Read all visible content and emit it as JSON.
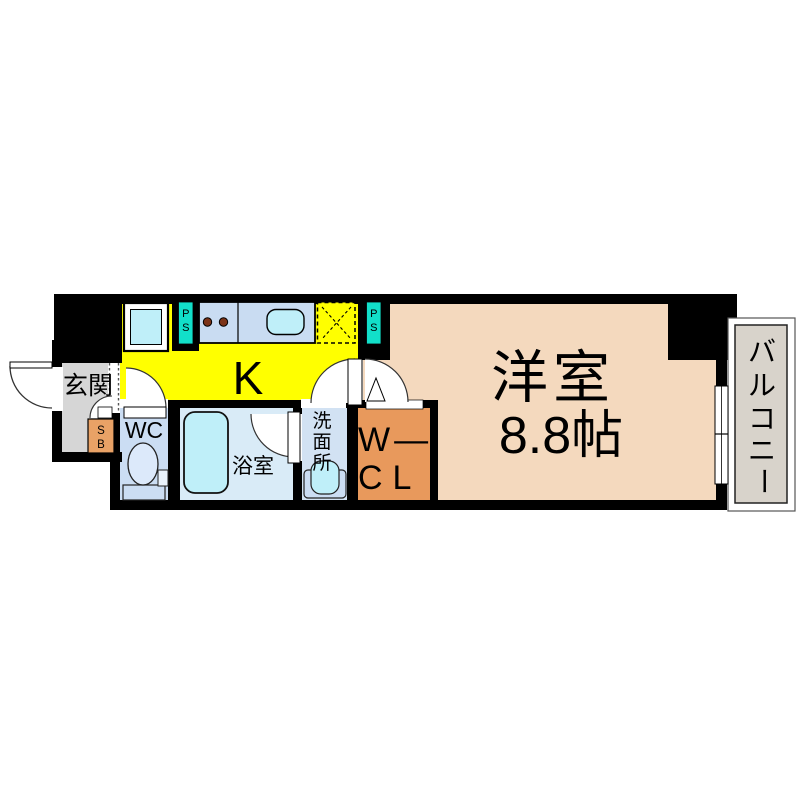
{
  "plan": {
    "type": "1K apartment floor plan"
  },
  "rooms": {
    "genkan": {
      "label": "玄関"
    },
    "kitchen": {
      "label": "K"
    },
    "wc": {
      "label": "WC"
    },
    "bathroom": {
      "label": "浴室"
    },
    "washroom": {
      "label": "洗面所",
      "chars": [
        "洗",
        "面",
        "所"
      ]
    },
    "wcl": {
      "label": "W—CL",
      "line1": "W—",
      "line2": "CL"
    },
    "western_room": {
      "label": "洋室",
      "size": "8.8帖"
    },
    "balcony": {
      "label": "バルコニー",
      "chars": [
        "バ",
        "ル",
        "コ",
        "ニ",
        "ー"
      ]
    }
  },
  "fixtures": {
    "ps": {
      "label": "PS",
      "chars": [
        "P",
        "S"
      ]
    },
    "sb": {
      "label": "SB",
      "chars": [
        "S",
        "B"
      ]
    }
  },
  "colors": {
    "wall": "#000000",
    "kitchen": "#FFFF00",
    "genkan": "#D6D6D6",
    "western": "#F4D9BE",
    "wc_room": "#CBDDF3",
    "bathroom": "#D9EBF7",
    "washroom": "#D2E2F3",
    "counter": "#C9DCF2",
    "cyan": "#BFEFF9",
    "toilet": "#DCE9FA",
    "wcl": "#E8995C",
    "sb": "#E9A266",
    "ps": "#12DFC9",
    "balcony": "#D8D3CB",
    "burner": "#7B3318"
  }
}
